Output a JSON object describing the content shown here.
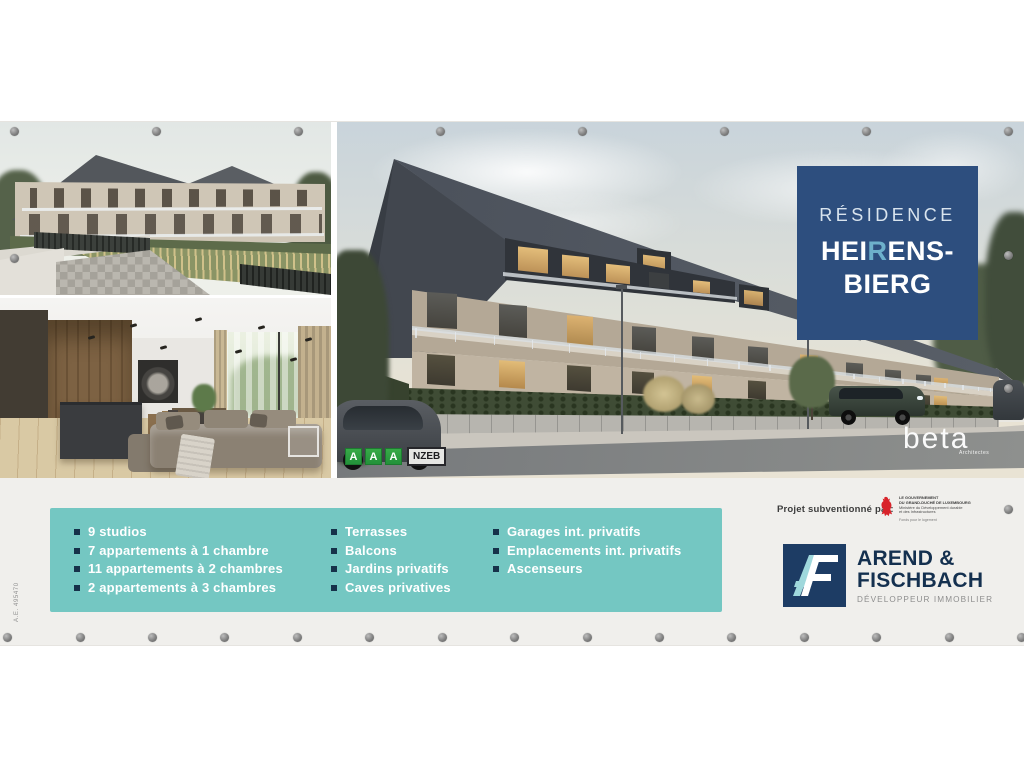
{
  "colors": {
    "teal_box": "#74c7c2",
    "bullet_navy": "#16324a",
    "title_box_blue": "#2d4e7e",
    "title_accent": "#6db0cb",
    "energy_green": "#2f9e3f",
    "gov_red": "#d8232a",
    "af_navy": "#1d3c64",
    "af_teal": "#9fd8dc",
    "strip_bg": "#f0efec"
  },
  "title_box": {
    "line1": "RÉSIDENCE",
    "line2_prefix": "HEI",
    "line2_accent": "R",
    "line2_suffix": "ENS-",
    "line3": "BIERG"
  },
  "energy": {
    "a1": "A",
    "a2": "A",
    "a3": "A",
    "cert": "NZEB"
  },
  "architect": {
    "name": "beta",
    "subtitle": "Architectes"
  },
  "features": {
    "col1": [
      "9 studios",
      "7 appartements à 1 chambre",
      "11 appartements à 2 chambres",
      "2 appartements à 3 chambres"
    ],
    "col2": [
      "Terrasses",
      "Balcons",
      "Jardins privatifs",
      "Caves privatives"
    ],
    "col3": [
      "Garages int. privatifs",
      "Emplacements int. privatifs",
      "Ascenseurs"
    ]
  },
  "sponsor": {
    "label": "Projet subventionné par:",
    "gov_line1": "LE GOUVERNEMENT",
    "gov_line2": "DU GRAND-DUCHÉ DE LUXEMBOURG",
    "gov_line3": "Ministère du Développement durable",
    "gov_line4": "et des Infrastructures",
    "gov_footer": "Fonds pour le logement"
  },
  "developer": {
    "name_line1": "AREND &",
    "name_line2": "FISCHBACH",
    "tagline": "DÉVELOPPEUR IMMOBILIER"
  },
  "side_note": "A.E. 495470"
}
